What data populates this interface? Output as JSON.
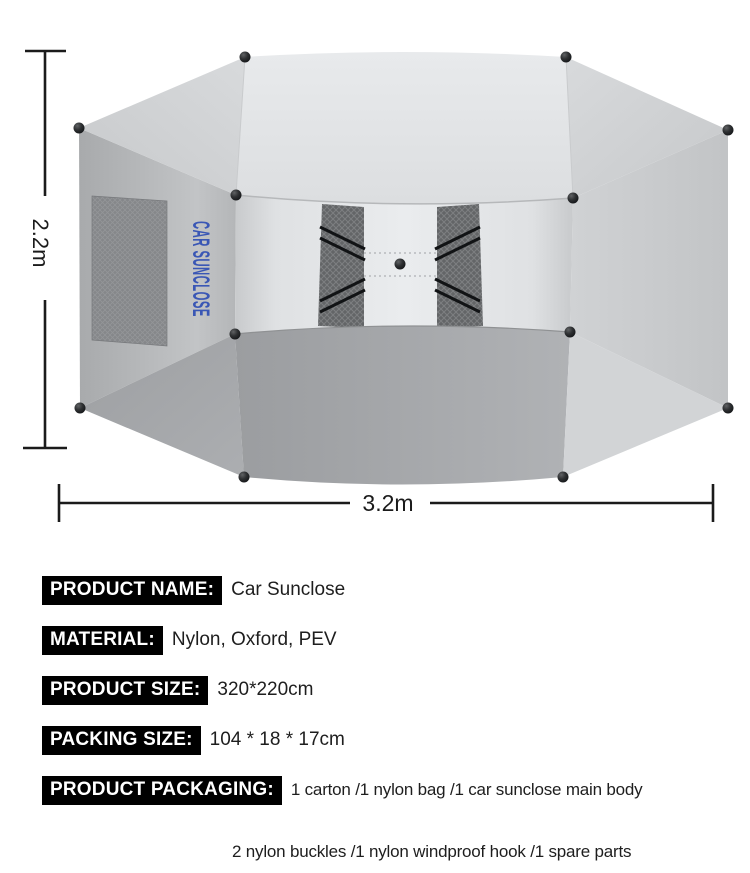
{
  "diagram": {
    "height_label": "2.2m",
    "width_label": "3.2m",
    "canopy_brand_text": "CAR SUNCLOSE",
    "colors": {
      "brand_text_blue": "#3a57b5",
      "dimension_line": "#1b1b1b",
      "knob_dark": "#17191b",
      "mesh_dark": "#636567",
      "badge_bg": "#000000",
      "badge_text": "#ffffff"
    }
  },
  "specs": {
    "rows": [
      {
        "label": "PRODUCT NAME:",
        "value": "Car Sunclose"
      },
      {
        "label": "MATERIAL:",
        "value": "Nylon, Oxford, PEV"
      },
      {
        "label": "PRODUCT SIZE:",
        "value": "320*220cm"
      },
      {
        "label": "PACKING SIZE:",
        "value": "104 * 18 * 17cm"
      },
      {
        "label": "PRODUCT PACKAGING:",
        "value": "1 carton /1 nylon bag /1 car sunclose main body"
      }
    ],
    "packaging_line2": "2 nylon buckles /1 nylon windproof hook /1 spare parts"
  }
}
